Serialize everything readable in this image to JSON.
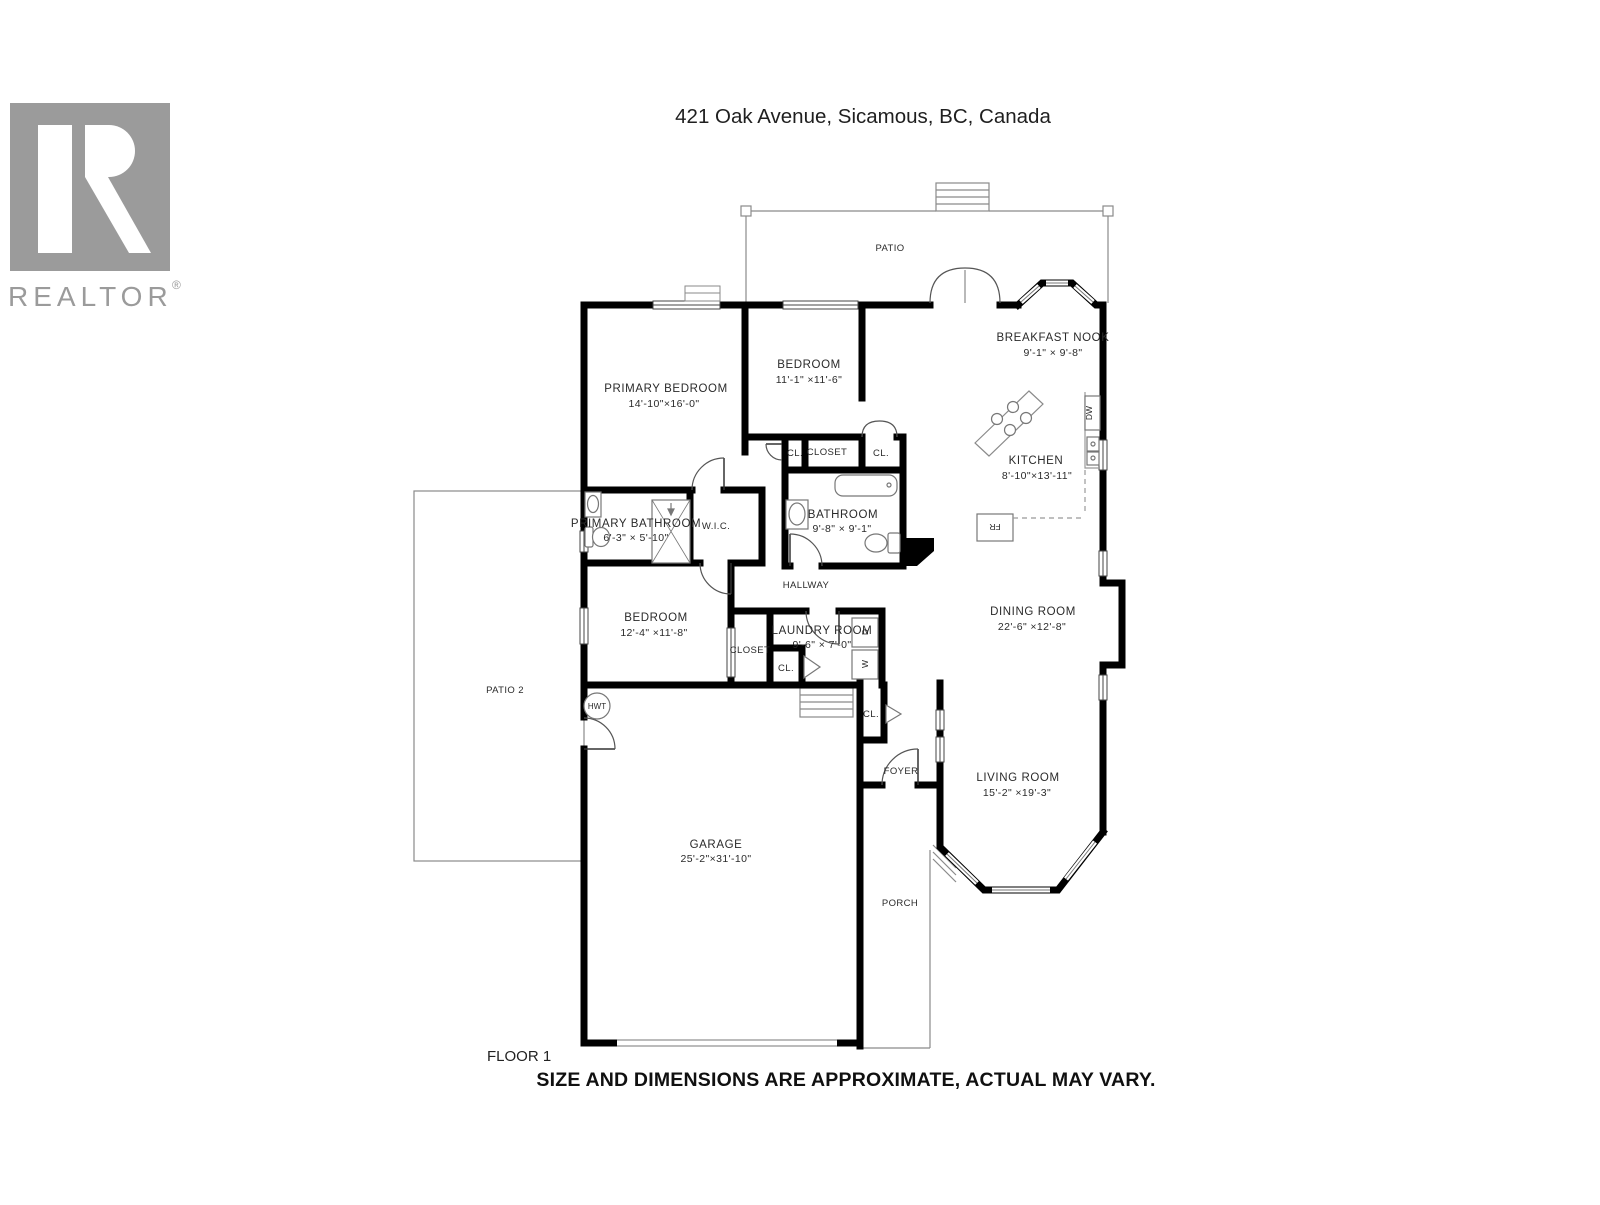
{
  "header": {
    "title": "421 Oak Avenue, Sicamous, BC, Canada"
  },
  "branding": {
    "logo_word": "REALTOR",
    "registered_mark": "®"
  },
  "floor_label": "FLOOR 1",
  "disclaimer": "SIZE AND DIMENSIONS ARE APPROXIMATE, ACTUAL MAY VARY.",
  "rooms": {
    "patio": {
      "label": "PATIO"
    },
    "patio2": {
      "label": "PATIO 2"
    },
    "porch": {
      "label": "PORCH"
    },
    "breakfast_nook": {
      "label": "BREAKFAST NOOK",
      "dims": "9'-1\" × 9'-8\""
    },
    "kitchen": {
      "label": "KITCHEN",
      "dims": "8'-10\"×13'-11\""
    },
    "primary_bedroom": {
      "label": "PRIMARY BEDROOM",
      "dims": "14'-10\"×16'-0\""
    },
    "bedroom_top": {
      "label": "BEDROOM",
      "dims": "11'-1\" ×11'-6\""
    },
    "bedroom_left": {
      "label": "BEDROOM",
      "dims": "12'-4\" ×11'-8\""
    },
    "bathroom": {
      "label": "BATHROOM",
      "dims": "9'-8\"  × 9'-1\""
    },
    "primary_bathroom": {
      "label": "PRIMARY BATHROOM",
      "dims": "6'-3\" × 5'-10\""
    },
    "wic": {
      "label": "W.I.C."
    },
    "hallway": {
      "label": "HALLWAY"
    },
    "closet_top": {
      "label": "CLOSET"
    },
    "closet_mid": {
      "label": "CLOSET"
    },
    "cl_left": {
      "label": "CL."
    },
    "cl_right": {
      "label": "CL."
    },
    "cl_laundry": {
      "label": "CL."
    },
    "cl_foyer": {
      "label": "CL."
    },
    "laundry": {
      "label": "LAUNDRY ROOM",
      "dims": "9'-6\" × 7'-0\""
    },
    "dining": {
      "label": "DINING ROOM",
      "dims": "22'-6\" ×12'-8\""
    },
    "living": {
      "label": "LIVING ROOM",
      "dims": "15'-2\" ×19'-3\""
    },
    "foyer": {
      "label": "FOYER"
    },
    "garage": {
      "label": "GARAGE",
      "dims": "25'-2\"×31'-10\""
    }
  },
  "fixtures": {
    "dishwasher": "DW",
    "fridge": "FR",
    "dryer": "D",
    "washer": "W",
    "hot_water_tank": "HWT"
  },
  "colors": {
    "wall": "#000000",
    "thin_line": "#8a8a8a",
    "fixture_line": "#777777",
    "label_text": "#2a2a2a",
    "logo_gray": "#9b9b9b"
  }
}
